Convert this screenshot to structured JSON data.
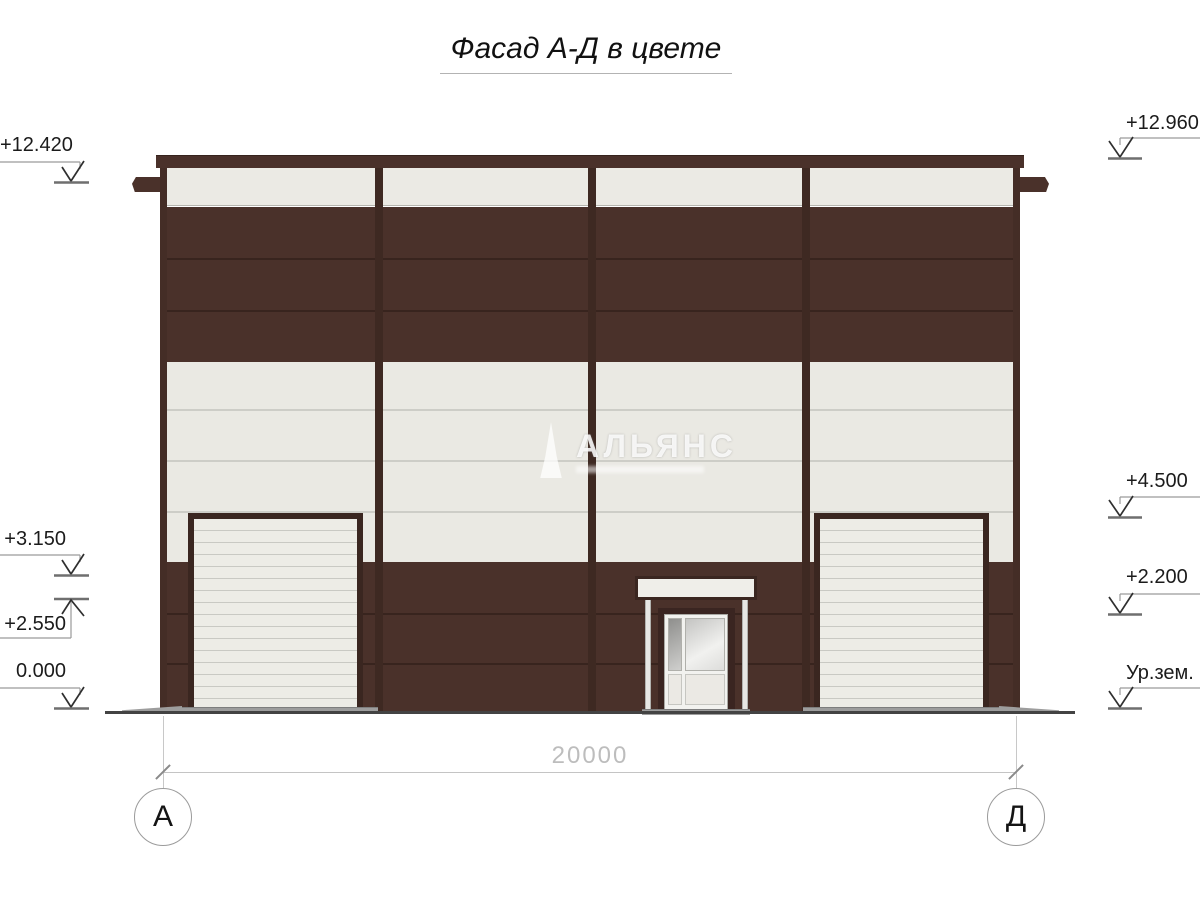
{
  "title": {
    "text": "Фасад А-Д в цвете"
  },
  "watermark": {
    "text": "АЛЬЯНС"
  },
  "markers": {
    "left": [
      {
        "label": "+12.420"
      },
      {
        "label": "+3.150"
      },
      {
        "label": "+2.550"
      },
      {
        "label": "0.000"
      }
    ],
    "right": [
      {
        "label": "+12.960"
      },
      {
        "label": "+4.500"
      },
      {
        "label": "+2.200"
      },
      {
        "label": "Ур.зем."
      }
    ]
  },
  "dimension": {
    "value": "20000"
  },
  "axes": {
    "left": "А",
    "right": "Д"
  },
  "colors": {
    "facade_brown": "#4a312a",
    "facade_cream": "#eae9e3",
    "frame_dark": "#3a2620",
    "dimension_gray": "#bdbdbd",
    "ground": "#434343"
  }
}
